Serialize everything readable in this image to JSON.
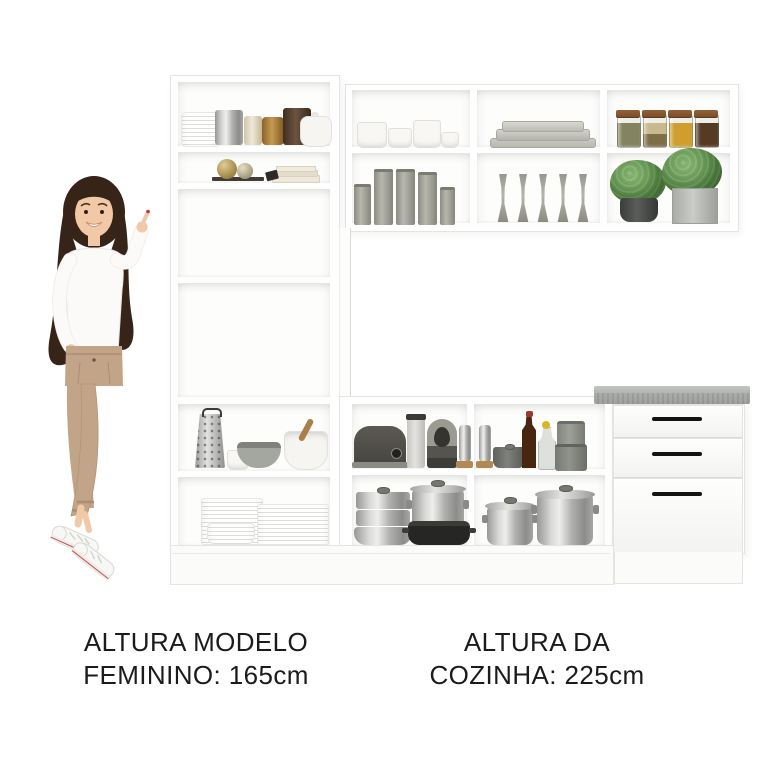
{
  "captions": {
    "left": {
      "line1": "ALTURA MODELO",
      "line2": "FEMININO: 165cm"
    },
    "right": {
      "line1": "ALTURA DA",
      "line2": "COZINHA: 225cm"
    }
  },
  "model": {
    "pose": "standing woman smiling and pointing up at the cabinet",
    "height_label": "165cm",
    "outfit": [
      "white long-sleeve top",
      "beige trousers",
      "white sneakers"
    ]
  },
  "kitchen": {
    "type": "compact white kitchen cabinet set",
    "height_label": "225cm",
    "tall_cabinet_shelves": [
      [
        "white ridged canister",
        "silver canister",
        "pearl canister",
        "amber jar",
        "brown tin box",
        "white teapot"
      ],
      [
        "two decor spheres on tray",
        "stacked books"
      ],
      [],
      [],
      [
        "box grater",
        "small cup",
        "gray bowl",
        "white mixing bowl with pestle"
      ],
      [
        "stack of plates",
        "stack of large plates",
        "stack of bowls"
      ]
    ],
    "wall_cabinet": {
      "row1": [
        [
          "espresso cups and saucers"
        ],
        [
          "stacked gray platters"
        ],
        [
          "four spice jars"
        ]
      ],
      "row2": [
        [
          "five pillar candles"
        ],
        [
          "five champagne flutes"
        ],
        [
          "two potted green plants"
        ]
      ]
    },
    "counter": {
      "row1": [
        [
          "dark toaster",
          "canister",
          "espresso machine",
          "pepper mill"
        ],
        [
          "pepper mill",
          "small saucepan",
          "brown bottle",
          "glass bottle with yellow stopper",
          "stacked gray canisters"
        ]
      ],
      "row2": [
        [
          "aluminium steamer stack",
          "stock pot with lid",
          "black roasting pan"
        ],
        [
          "pot with lid",
          "large pot with lid"
        ]
      ]
    },
    "drawer_unit": {
      "drawer_count": 3,
      "countertop": "gray stone"
    }
  },
  "colors": {
    "text": "#1b1b1b",
    "edge": "#e4e4e1",
    "line": "#d8d8d5",
    "interior": "#fdfdfc",
    "counter_top": "#b2b5b1",
    "counter_front": "#9a9d99",
    "handle": "#141414",
    "metal_light": "#eeeeec",
    "metal_dark": "#8c8c8a",
    "gray_plate": "#b9b9b1",
    "spice_lid": "#7b4f2a",
    "skin": "#f1c9a6",
    "hair": "#372419",
    "blouse": "#fbfaf8",
    "pants": "#c2a489",
    "shoe": "#f7f7f5",
    "nail": "#c03a3a"
  }
}
